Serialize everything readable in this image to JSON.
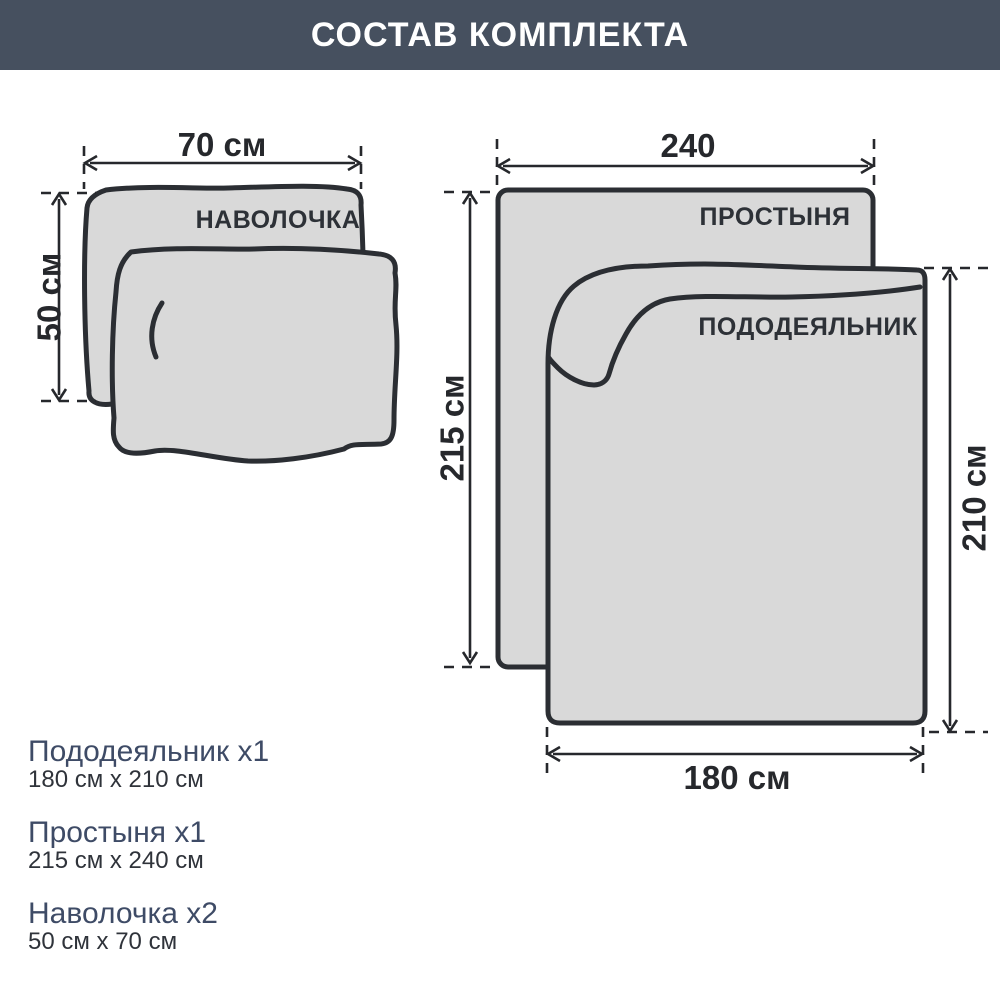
{
  "header": {
    "title": "СОСТАВ КОМПЛЕКТА"
  },
  "diagram": {
    "pillow": {
      "label": "НАВОЛОЧКА",
      "width_label": "70 см",
      "height_label": "50 см"
    },
    "sheet": {
      "label": "ПРОСТЫНЯ",
      "width_label": "240",
      "height_label": "215 см"
    },
    "duvet": {
      "label": "ПОДОДЕЯЛЬНИК",
      "width_label": "180 см",
      "height_label": "210 см"
    }
  },
  "legend": {
    "items": [
      {
        "name": "Пододеяльник х1",
        "size": "180 см x 210 см"
      },
      {
        "name": "Простыня х1",
        "size": "215 см x 240 см"
      },
      {
        "name": "Наволочка х2",
        "size": "50 см x 70 см"
      }
    ]
  },
  "colors": {
    "header_bg": "#46505f",
    "header_text": "#ffffff",
    "fabric_fill": "#d9d9d9",
    "outline": "#2b2e33",
    "annotation": "#26282c",
    "legend_name": "#3e4b66",
    "legend_size": "#2f333a"
  }
}
